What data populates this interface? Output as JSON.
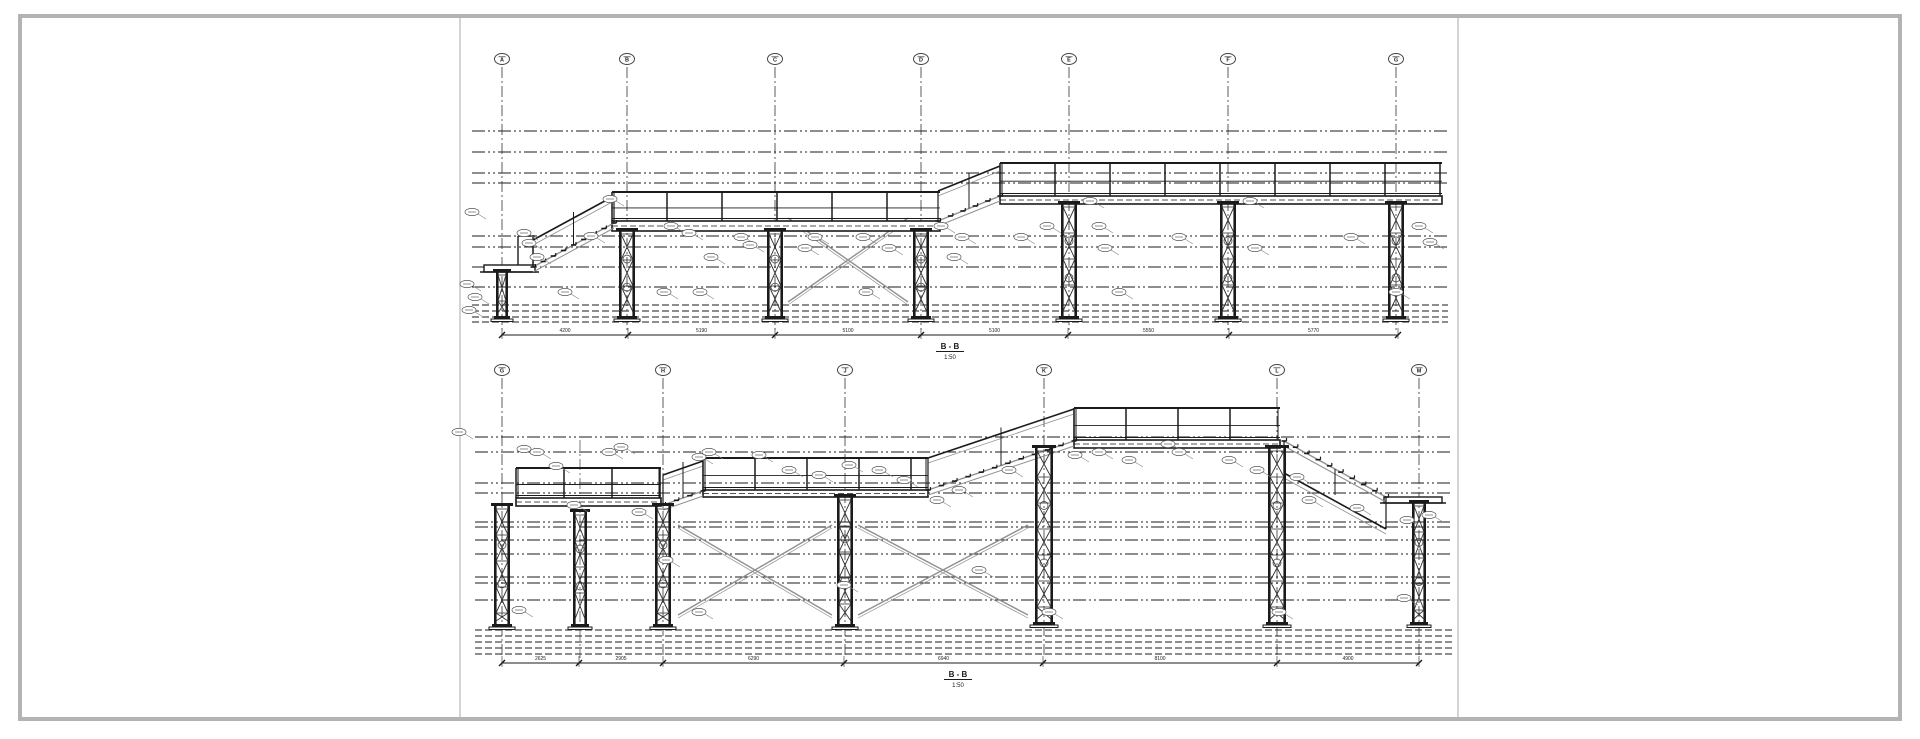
{
  "sheet": {
    "background": "#ffffff",
    "frame_color": "#b3b3b3",
    "divider_color": "#c6c6c6",
    "line_color": "#1b1b1b",
    "gray_line_color": "#909090",
    "frame": {
      "x": 20,
      "y": 16,
      "w": 1880,
      "h": 703
    },
    "dividers_x": [
      460,
      1458
    ]
  },
  "drawing": {
    "sections": [
      {
        "name": "B - B",
        "scale": "1:50",
        "label": {
          "x": 950,
          "y": 349
        },
        "bubble_y": 59,
        "grid_top": 67,
        "grid_bottom": 330,
        "grids": [
          {
            "label": "A",
            "x": 502
          },
          {
            "label": "B",
            "x": 627
          },
          {
            "label": "C",
            "x": 775
          },
          {
            "label": "D",
            "x": 921
          },
          {
            "label": "E",
            "x": 1069
          },
          {
            "label": "F",
            "x": 1228
          },
          {
            "label": "G",
            "x": 1396
          }
        ],
        "minor_grids": [],
        "extent": {
          "left": 472,
          "right": 1448
        },
        "level_lines": [
          131,
          152,
          173,
          183,
          236,
          247,
          267,
          287
        ],
        "ground_lines": [
          305,
          311,
          317,
          322
        ],
        "platforms": [
          {
            "x1": 484,
            "x2": 535,
            "top": 265,
            "bot": 272,
            "rail_x": [
              518,
              533
            ],
            "rail_top": 236
          }
        ],
        "decks": [
          {
            "x1": 612,
            "x2": 940,
            "top": 221,
            "bot": 231,
            "rail_top": 192,
            "post_spacing": 55
          },
          {
            "x1": 1000,
            "x2": 1442,
            "top": 196,
            "bot": 204,
            "rail_top": 163,
            "post_spacing": 55
          }
        ],
        "stairs": [
          {
            "x1": 533,
            "y1": 267,
            "x2": 614,
            "y2": 223,
            "rail_dy": 27,
            "steps": 9
          },
          {
            "x1": 938,
            "y1": 221,
            "x2": 1000,
            "y2": 196,
            "rail_dy": 30,
            "steps": 6
          }
        ],
        "columns": [
          {
            "x": 502,
            "top": 272,
            "bot": 316,
            "w": 12
          },
          {
            "x": 627,
            "top": 231,
            "bot": 316,
            "w": 16
          },
          {
            "x": 775,
            "top": 231,
            "bot": 316,
            "w": 16
          },
          {
            "x": 921,
            "top": 231,
            "bot": 316,
            "w": 16
          },
          {
            "x": 1069,
            "top": 204,
            "bot": 316,
            "w": 16
          },
          {
            "x": 1228,
            "top": 204,
            "bot": 316,
            "w": 16
          },
          {
            "x": 1396,
            "top": 204,
            "bot": 316,
            "w": 16
          }
        ],
        "xbraces": [
          {
            "x1": 788,
            "x2": 908,
            "y1": 218,
            "y2": 302
          }
        ],
        "dimension": {
          "y": 335,
          "ticks": [
            502,
            628,
            775,
            921,
            1068,
            1229,
            1398
          ],
          "values": [
            "4200",
            "5190",
            "5100",
            "5100",
            "5550",
            "5770"
          ]
        },
        "annotations": [
          [
            472,
            212
          ],
          [
            467,
            284
          ],
          [
            475,
            297
          ],
          [
            469,
            310
          ],
          [
            524,
            233
          ],
          [
            529,
            243
          ],
          [
            537,
            257
          ],
          [
            610,
            199
          ],
          [
            591,
            236
          ],
          [
            565,
            292
          ],
          [
            671,
            226
          ],
          [
            689,
            233
          ],
          [
            664,
            292
          ],
          [
            711,
            257
          ],
          [
            741,
            237
          ],
          [
            750,
            245
          ],
          [
            805,
            248
          ],
          [
            815,
            237
          ],
          [
            863,
            237
          ],
          [
            889,
            248
          ],
          [
            941,
            226
          ],
          [
            954,
            257
          ],
          [
            962,
            237
          ],
          [
            1021,
            237
          ],
          [
            1047,
            226
          ],
          [
            1090,
            201
          ],
          [
            1099,
            226
          ],
          [
            1105,
            248
          ],
          [
            1179,
            237
          ],
          [
            1250,
            201
          ],
          [
            1255,
            248
          ],
          [
            1351,
            237
          ],
          [
            1419,
            226
          ],
          [
            1430,
            242
          ],
          [
            1396,
            292
          ],
          [
            866,
            292
          ],
          [
            1119,
            292
          ],
          [
            700,
            292
          ]
        ]
      },
      {
        "name": "B - B",
        "scale": "1:50",
        "label": {
          "x": 958,
          "y": 677
        },
        "bubble_y": 370,
        "grid_top": 378,
        "grid_bottom": 658,
        "grids": [
          {
            "label": "G",
            "x": 502
          },
          {
            "label": "H",
            "x": 663
          },
          {
            "label": "J",
            "x": 845
          },
          {
            "label": "K",
            "x": 1044
          },
          {
            "label": "L",
            "x": 1277
          },
          {
            "label": "M",
            "x": 1419
          }
        ],
        "minor_grids": [
          {
            "x": 580,
            "y1": 440,
            "y2": 658
          }
        ],
        "extent": {
          "left": 475,
          "right": 1452
        },
        "level_lines": [
          437,
          452,
          483,
          493,
          522,
          527,
          540,
          554,
          577,
          583,
          600
        ],
        "ground_lines": [
          630,
          636,
          642,
          648,
          654
        ],
        "platforms": [
          {
            "x1": 1384,
            "x2": 1442,
            "top": 497,
            "bot": 503,
            "rail_x": [],
            "rail_top": 0
          }
        ],
        "decks": [
          {
            "x1": 516,
            "x2": 661,
            "top": 498,
            "bot": 506,
            "rail_top": 468,
            "post_spacing": 48
          },
          {
            "x1": 703,
            "x2": 928,
            "top": 490,
            "bot": 497,
            "rail_top": 458,
            "post_spacing": 52
          },
          {
            "x1": 1074,
            "x2": 1280,
            "top": 440,
            "bot": 448,
            "rail_top": 408,
            "post_spacing": 52
          }
        ],
        "stairs": [
          {
            "x1": 663,
            "y1": 505,
            "x2": 703,
            "y2": 491,
            "rail_dy": 30,
            "steps": 4
          },
          {
            "x1": 928,
            "y1": 490,
            "x2": 1074,
            "y2": 441,
            "rail_dy": 32,
            "steps": 12
          },
          {
            "x1": 1284,
            "y1": 441,
            "x2": 1386,
            "y2": 497,
            "rail_dy": -32,
            "steps": 10
          }
        ],
        "columns": [
          {
            "x": 502,
            "top": 506,
            "bot": 624,
            "w": 16
          },
          {
            "x": 580,
            "top": 512,
            "bot": 624,
            "w": 14
          },
          {
            "x": 663,
            "top": 506,
            "bot": 624,
            "w": 16
          },
          {
            "x": 845,
            "top": 497,
            "bot": 624,
            "w": 16
          },
          {
            "x": 1044,
            "top": 448,
            "bot": 622,
            "w": 18
          },
          {
            "x": 1277,
            "top": 448,
            "bot": 622,
            "w": 18
          },
          {
            "x": 1419,
            "top": 503,
            "bot": 622,
            "w": 14
          }
        ],
        "xbraces": [
          {
            "x1": 678,
            "x2": 832,
            "y1": 525,
            "y2": 615
          },
          {
            "x1": 858,
            "x2": 1028,
            "y1": 525,
            "y2": 615
          }
        ],
        "dimension": {
          "y": 663,
          "ticks": [
            502,
            579,
            663,
            844,
            1043,
            1277,
            1419
          ],
          "values": [
            "2625",
            "2905",
            "6290",
            "6940",
            "8100",
            "4900"
          ]
        },
        "annotations": [
          [
            459,
            432
          ],
          [
            524,
            449
          ],
          [
            537,
            452
          ],
          [
            556,
            466
          ],
          [
            609,
            452
          ],
          [
            621,
            447
          ],
          [
            574,
            505
          ],
          [
            639,
            512
          ],
          [
            699,
            457
          ],
          [
            709,
            452
          ],
          [
            759,
            455
          ],
          [
            789,
            470
          ],
          [
            819,
            475
          ],
          [
            849,
            465
          ],
          [
            879,
            470
          ],
          [
            904,
            480
          ],
          [
            937,
            500
          ],
          [
            959,
            490
          ],
          [
            1009,
            470
          ],
          [
            1075,
            455
          ],
          [
            1099,
            452
          ],
          [
            1129,
            460
          ],
          [
            1168,
            444
          ],
          [
            1179,
            452
          ],
          [
            1229,
            460
          ],
          [
            1257,
            470
          ],
          [
            1297,
            477
          ],
          [
            1309,
            500
          ],
          [
            1357,
            508
          ],
          [
            1407,
            520
          ],
          [
            1429,
            515
          ],
          [
            666,
            560
          ],
          [
            844,
            585
          ],
          [
            979,
            570
          ],
          [
            519,
            610
          ],
          [
            699,
            612
          ],
          [
            1049,
            612
          ],
          [
            1279,
            612
          ],
          [
            1404,
            598
          ]
        ]
      }
    ]
  }
}
